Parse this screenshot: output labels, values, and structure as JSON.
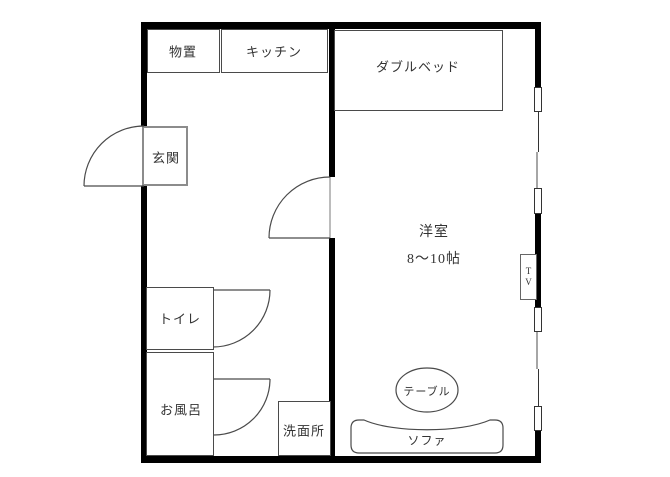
{
  "floorplan": {
    "rooms": {
      "storage": "物置",
      "kitchen": "キッチン",
      "entrance": "玄関",
      "toilet": "トイレ",
      "bath": "お風呂",
      "washroom": "洗面所",
      "western_room": "洋室",
      "western_room_size": "8〜10帖"
    },
    "furniture": {
      "double_bed": "ダブルベッド",
      "table": "テーブル",
      "sofa": "ソファ",
      "tv_line1": "T",
      "tv_line2": "V"
    },
    "colors": {
      "wall": "#000000",
      "line": "#4a4a4a",
      "gray_line": "#a6a6a6",
      "text": "#333333",
      "background": "#ffffff"
    }
  }
}
